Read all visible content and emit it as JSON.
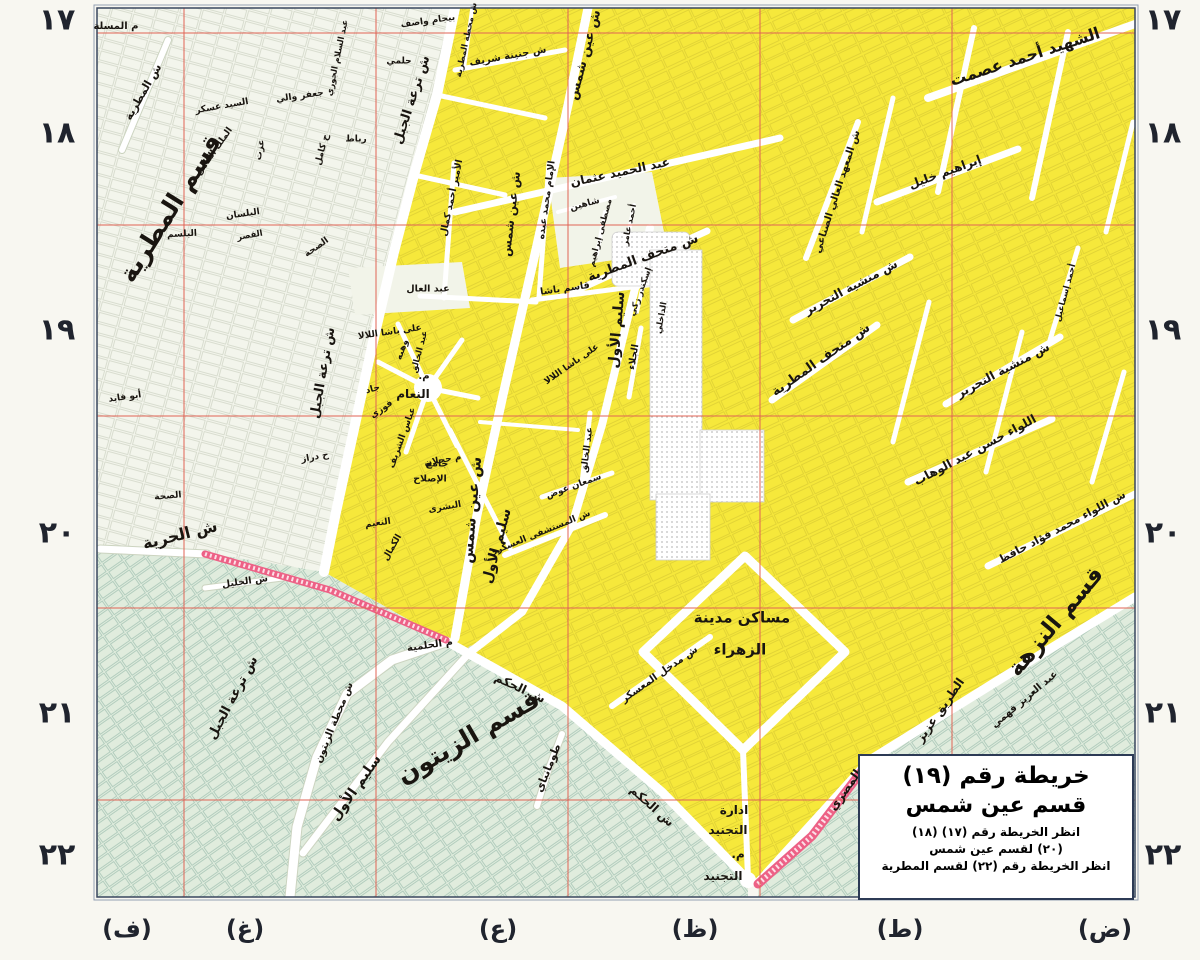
{
  "colors": {
    "bg": "#f8f7f1",
    "district_yellow": "#f6e83b",
    "district_green": "#e0ecdd",
    "district_white": "#f3f5ec",
    "road_white": "#ffffff",
    "rail_pink": "#ed6186",
    "grid_red": "#e06355",
    "frame_dark": "#39465e",
    "frame_light": "#93a0b4",
    "label": "#191510",
    "margin_text": "#20242e",
    "title_border": "#2c3a55"
  },
  "title_box": {
    "line1": "خريطة رقم (١٩)",
    "line2": "قسم عين شمس",
    "note1": "انظر الخريطة رقم (١٧) (١٨)",
    "note2": "(٢٠) لقسم عين شمس",
    "note3": "انظر الخريطة رقم (٢٢) لقسم المطرية"
  },
  "margins": {
    "row_numbers": [
      {
        "label": "١٧",
        "y": 20
      },
      {
        "label": "١٨",
        "y": 133
      },
      {
        "label": "١٩",
        "y": 330
      },
      {
        "label": "٢٠",
        "y": 533
      },
      {
        "label": "٢١",
        "y": 713
      },
      {
        "label": "٢٢",
        "y": 855
      }
    ],
    "row_number_x_left": 57,
    "row_number_x_right": 1163,
    "col_letters": [
      {
        "label": "(ف)",
        "x": 127
      },
      {
        "label": "(غ)",
        "x": 245
      },
      {
        "label": "(ع)",
        "x": 498
      },
      {
        "label": "(ظ)",
        "x": 695
      },
      {
        "label": "(ط)",
        "x": 900
      },
      {
        "label": "(ض)",
        "x": 1105
      }
    ],
    "col_letter_y": 929
  },
  "map": {
    "labels": [
      {
        "t": "قسم المطرية",
        "x": 170,
        "y": 208,
        "r": -58,
        "s": 25,
        "w": 800
      },
      {
        "t": "قسم الزيتون",
        "x": 468,
        "y": 737,
        "r": -30,
        "s": 25,
        "w": 800
      },
      {
        "t": "قسم النزهة",
        "x": 1056,
        "y": 622,
        "r": -50,
        "s": 23,
        "w": 800
      },
      {
        "t": "الشهيد أحمد عصمت",
        "x": 1025,
        "y": 57,
        "r": -18,
        "s": 16,
        "w": 700
      },
      {
        "t": "ش الحرية",
        "x": 180,
        "y": 535,
        "r": -14,
        "s": 16,
        "w": 700
      },
      {
        "t": "ش ترعة الجبل",
        "x": 412,
        "y": 100,
        "r": -72,
        "s": 13,
        "w": 700
      },
      {
        "t": "ش ترعة الجبل",
        "x": 323,
        "y": 373,
        "r": -80,
        "s": 13,
        "w": 700
      },
      {
        "t": "ش ترعة الجبل",
        "x": 233,
        "y": 698,
        "r": -62,
        "s": 13,
        "w": 700
      },
      {
        "t": "ش عين شمس",
        "x": 585,
        "y": 55,
        "r": -75,
        "s": 13,
        "w": 700
      },
      {
        "t": "ش عين شمس",
        "x": 511,
        "y": 214,
        "r": -83,
        "s": 12,
        "w": 700
      },
      {
        "t": "ش عين شمس",
        "x": 472,
        "y": 510,
        "r": -85,
        "s": 15,
        "w": 700
      },
      {
        "t": "سليم الأول",
        "x": 617,
        "y": 330,
        "r": -85,
        "s": 14,
        "w": 700
      },
      {
        "t": "سليم الأول",
        "x": 497,
        "y": 546,
        "r": -75,
        "s": 14,
        "w": 700
      },
      {
        "t": "سليم الأول",
        "x": 356,
        "y": 788,
        "r": -55,
        "s": 14,
        "w": 700
      },
      {
        "t": "ش متحف المطرية",
        "x": 643,
        "y": 258,
        "r": -20,
        "s": 13,
        "w": 700
      },
      {
        "t": "ش متحف المطرية",
        "x": 821,
        "y": 360,
        "r": -35,
        "s": 13,
        "w": 700
      },
      {
        "t": "ش منشية التحرير",
        "x": 851,
        "y": 287,
        "r": -28,
        "s": 12,
        "w": 700
      },
      {
        "t": "ش منشية التحرير",
        "x": 1003,
        "y": 370,
        "r": -28,
        "s": 12,
        "w": 700
      },
      {
        "t": "اللواء حسن عبد الوهاب",
        "x": 975,
        "y": 450,
        "r": -28,
        "s": 12,
        "w": 700
      },
      {
        "t": "ش اللواء محمد فؤاد حافظ",
        "x": 1062,
        "y": 527,
        "r": -28,
        "s": 11,
        "w": 700
      },
      {
        "t": "إبراهيم خليل",
        "x": 945,
        "y": 172,
        "r": -20,
        "s": 12,
        "w": 700
      },
      {
        "t": "عبد الحميد عثمان",
        "x": 620,
        "y": 172,
        "r": -12,
        "s": 12,
        "w": 700
      },
      {
        "t": "ش المعهد العالي الصناعي",
        "x": 838,
        "y": 192,
        "r": -72,
        "s": 10,
        "w": 700
      },
      {
        "t": "ش الحكم",
        "x": 520,
        "y": 688,
        "r": 25,
        "s": 12,
        "w": 700
      },
      {
        "t": "ش الحكم",
        "x": 652,
        "y": 806,
        "r": 42,
        "s": 12,
        "w": 700
      },
      {
        "t": "الطريق عزيز",
        "x": 940,
        "y": 710,
        "r": -55,
        "s": 12,
        "w": 700
      },
      {
        "t": "المصري",
        "x": 845,
        "y": 790,
        "r": -55,
        "s": 12,
        "w": 700
      },
      {
        "t": "ش محطة الزيتون",
        "x": 335,
        "y": 723,
        "r": -68,
        "s": 10,
        "w": 700
      },
      {
        "t": "طومانباي",
        "x": 548,
        "y": 768,
        "r": -68,
        "s": 11,
        "w": 700
      },
      {
        "t": "ش مدخل المعسكر",
        "x": 660,
        "y": 675,
        "r": -35,
        "s": 10,
        "w": 700
      },
      {
        "t": "مساكن مدينة",
        "x": 742,
        "y": 618,
        "r": 0,
        "s": 15,
        "w": 700
      },
      {
        "t": "الزهراء",
        "x": 740,
        "y": 650,
        "r": 0,
        "s": 15,
        "w": 700
      },
      {
        "t": "ادارة",
        "x": 734,
        "y": 810,
        "r": 0,
        "s": 12,
        "w": 700
      },
      {
        "t": "التجنيد",
        "x": 728,
        "y": 830,
        "r": 0,
        "s": 12,
        "w": 700
      },
      {
        "t": "م.",
        "x": 738,
        "y": 854,
        "r": 0,
        "s": 12,
        "w": 700
      },
      {
        "t": "التجنيد",
        "x": 723,
        "y": 876,
        "r": 0,
        "s": 12,
        "w": 700
      },
      {
        "t": "عبد العزيز فهمي",
        "x": 1025,
        "y": 700,
        "r": -40,
        "s": 10,
        "w": 700
      },
      {
        "t": "م الحلمية",
        "x": 430,
        "y": 646,
        "r": -8,
        "s": 10,
        "w": 700
      },
      {
        "t": "ش المستشفى العسكري",
        "x": 540,
        "y": 534,
        "r": -22,
        "s": 9,
        "w": 700
      },
      {
        "t": "م المسلة",
        "x": 116,
        "y": 27,
        "r": 0,
        "s": 10,
        "w": 600
      },
      {
        "t": "ش المطرية",
        "x": 143,
        "y": 92,
        "r": -60,
        "s": 11,
        "w": 700
      },
      {
        "t": "السيد عسكر",
        "x": 222,
        "y": 107,
        "r": -10,
        "s": 9,
        "w": 600
      },
      {
        "t": "جعفر والي",
        "x": 300,
        "y": 97,
        "r": -8,
        "s": 9,
        "w": 600
      },
      {
        "t": "عبد السلام الجوري",
        "x": 338,
        "y": 58,
        "r": -78,
        "s": 8.5,
        "w": 600
      },
      {
        "t": "الملك الكامل",
        "x": 215,
        "y": 152,
        "r": -55,
        "s": 9,
        "w": 600
      },
      {
        "t": "عزت",
        "x": 261,
        "y": 150,
        "r": -80,
        "s": 9,
        "w": 600
      },
      {
        "t": "ح كامل",
        "x": 323,
        "y": 150,
        "r": -75,
        "s": 9,
        "w": 600
      },
      {
        "t": "رباط",
        "x": 356,
        "y": 140,
        "r": 0,
        "s": 9,
        "w": 600
      },
      {
        "t": "البلسان",
        "x": 243,
        "y": 215,
        "r": -8,
        "s": 9,
        "w": 600
      },
      {
        "t": "القصر",
        "x": 250,
        "y": 236,
        "r": -10,
        "s": 8.5,
        "w": 600
      },
      {
        "t": "البلسم",
        "x": 182,
        "y": 235,
        "r": -3,
        "s": 9,
        "w": 600
      },
      {
        "t": "الصحة",
        "x": 317,
        "y": 248,
        "r": -35,
        "s": 9,
        "w": 600
      },
      {
        "t": "أبو فايد",
        "x": 125,
        "y": 398,
        "r": -8,
        "s": 9,
        "w": 600
      },
      {
        "t": "ح دراز",
        "x": 315,
        "y": 458,
        "r": -10,
        "s": 9,
        "w": 600
      },
      {
        "t": "الصحة",
        "x": 168,
        "y": 497,
        "r": -5,
        "s": 9,
        "w": 600
      },
      {
        "t": "ش الخليل",
        "x": 245,
        "y": 582,
        "r": -8,
        "s": 9.5,
        "w": 600
      },
      {
        "t": "بيجام واصف",
        "x": 428,
        "y": 22,
        "r": -8,
        "s": 9,
        "w": 600
      },
      {
        "t": "حلمي",
        "x": 399,
        "y": 62,
        "r": 0,
        "s": 9,
        "w": 600
      },
      {
        "t": "ش محطة المطرية",
        "x": 467,
        "y": 40,
        "r": -78,
        "s": 8.5,
        "w": 600
      },
      {
        "t": "ش جنينة شريف",
        "x": 508,
        "y": 57,
        "r": -10,
        "s": 10,
        "w": 600
      },
      {
        "t": "عبد العال",
        "x": 428,
        "y": 289,
        "r": 0,
        "s": 9.5,
        "w": 600
      },
      {
        "t": "على باشا اللالا",
        "x": 390,
        "y": 333,
        "r": -8,
        "s": 9,
        "w": 600
      },
      {
        "t": "على باشا اللالا",
        "x": 572,
        "y": 365,
        "r": -35,
        "s": 9,
        "w": 600
      },
      {
        "t": "جاد",
        "x": 373,
        "y": 390,
        "r": -15,
        "s": 9,
        "w": 600
      },
      {
        "t": "فوزي",
        "x": 382,
        "y": 410,
        "r": -35,
        "s": 9,
        "w": 600
      },
      {
        "t": "وهبه",
        "x": 403,
        "y": 350,
        "r": -70,
        "s": 9,
        "w": 600
      },
      {
        "t": "عبد الخالق",
        "x": 420,
        "y": 352,
        "r": -75,
        "s": 8.5,
        "w": 600
      },
      {
        "t": "م.",
        "x": 424,
        "y": 377,
        "r": 0,
        "s": 10,
        "w": 700
      },
      {
        "t": "النعام",
        "x": 413,
        "y": 394,
        "r": 0,
        "s": 12,
        "w": 700
      },
      {
        "t": "م حجلان",
        "x": 443,
        "y": 461,
        "r": -10,
        "s": 9,
        "w": 600
      },
      {
        "t": "عباس الشريف",
        "x": 403,
        "y": 438,
        "r": -70,
        "s": 9,
        "w": 600
      },
      {
        "t": "جامع",
        "x": 437,
        "y": 464,
        "r": 0,
        "s": 9.5,
        "w": 600
      },
      {
        "t": "الإصلاح",
        "x": 430,
        "y": 479,
        "r": 0,
        "s": 9.5,
        "w": 600
      },
      {
        "t": "البشرى",
        "x": 445,
        "y": 508,
        "r": -10,
        "s": 9,
        "w": 600
      },
      {
        "t": "النعيم",
        "x": 378,
        "y": 524,
        "r": -8,
        "s": 9,
        "w": 600
      },
      {
        "t": "الكمال",
        "x": 393,
        "y": 548,
        "r": -60,
        "s": 9,
        "w": 600
      },
      {
        "t": "الأمير أحمد كمال",
        "x": 452,
        "y": 198,
        "r": -78,
        "s": 9.5,
        "w": 600
      },
      {
        "t": "الإمام محمد عبده",
        "x": 547,
        "y": 200,
        "r": -82,
        "s": 9.5,
        "w": 600
      },
      {
        "t": "شاهين",
        "x": 585,
        "y": 205,
        "r": -15,
        "s": 9,
        "w": 600
      },
      {
        "t": "مصطفى إبراهيم",
        "x": 601,
        "y": 233,
        "r": -75,
        "s": 8.5,
        "w": 600
      },
      {
        "t": "أحمد عامر",
        "x": 630,
        "y": 225,
        "r": -78,
        "s": 8.5,
        "w": 600
      },
      {
        "t": "إسكندر زكي",
        "x": 641,
        "y": 292,
        "r": -70,
        "s": 8.5,
        "w": 600
      },
      {
        "t": "قاسم باشا",
        "x": 565,
        "y": 289,
        "r": -8,
        "s": 9.5,
        "w": 600
      },
      {
        "t": "الجلاء",
        "x": 634,
        "y": 357,
        "r": -80,
        "s": 9.5,
        "w": 600
      },
      {
        "t": "الداخلي",
        "x": 662,
        "y": 318,
        "r": -80,
        "s": 8.5,
        "w": 600
      },
      {
        "t": "عبد الخالق",
        "x": 588,
        "y": 450,
        "r": -83,
        "s": 9,
        "w": 600
      },
      {
        "t": "سمعان عوض",
        "x": 574,
        "y": 487,
        "r": -20,
        "s": 9,
        "w": 600
      },
      {
        "t": "أحمد إسماعيل",
        "x": 1066,
        "y": 293,
        "r": -75,
        "s": 8.5,
        "w": 600
      }
    ]
  }
}
